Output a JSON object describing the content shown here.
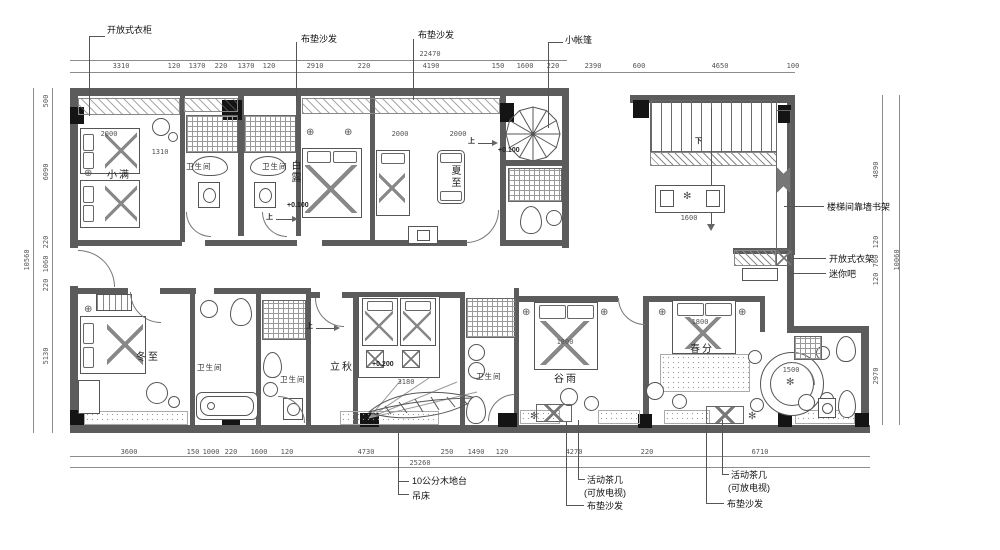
{
  "title": "guesthouse-floor-plan",
  "callouts": {
    "top": [
      "开放式衣柜",
      "布垫沙发",
      "布垫沙发",
      "小帐篷"
    ],
    "right": [
      "楼梯间靠墙书架",
      "开放式衣架",
      "迷你吧"
    ],
    "bottom": [
      "10公分木地台",
      "吊床",
      "活动茶几",
      "(可放电视)",
      "布垫沙发",
      "活动茶几",
      "(可放电视)",
      "布垫沙发"
    ]
  },
  "rooms": [
    "小满",
    "卫生间",
    "卫生间",
    "白露",
    "夏至",
    "冬至",
    "卫生间",
    "卫生间",
    "立秋",
    "卫生间",
    "谷雨",
    "春分"
  ],
  "levels": [
    "+0.100",
    "+0.100",
    "+0.200"
  ],
  "arrows": {
    "up": "上",
    "down": "下"
  },
  "dims": {
    "top_total": "22470",
    "top": [
      "3310",
      "120",
      "1370",
      "220",
      "1370",
      "120",
      "2910",
      "220",
      "4190",
      "150",
      "1600",
      "220",
      "2390",
      "600",
      "4650",
      "100"
    ],
    "bottom": [
      "3600",
      "150",
      "1000",
      "220",
      "1600",
      "120",
      "4730",
      "250",
      "1490",
      "120",
      "4270",
      "220",
      "6710"
    ],
    "bottom_total": "25260",
    "left": [
      "500",
      "6090",
      "220",
      "1060",
      "220",
      "5130"
    ],
    "left_total": "10560",
    "right": [
      "4890",
      "120",
      "760",
      "120",
      "2970"
    ],
    "right_total": "10060",
    "inline": [
      "2000",
      "1310",
      "2000",
      "2000",
      "1800",
      "1800",
      "1600",
      "1500",
      "3180"
    ]
  },
  "colors": {
    "wall": "#5c5c5c",
    "line": "#8c8c8c",
    "text": "#333333"
  }
}
